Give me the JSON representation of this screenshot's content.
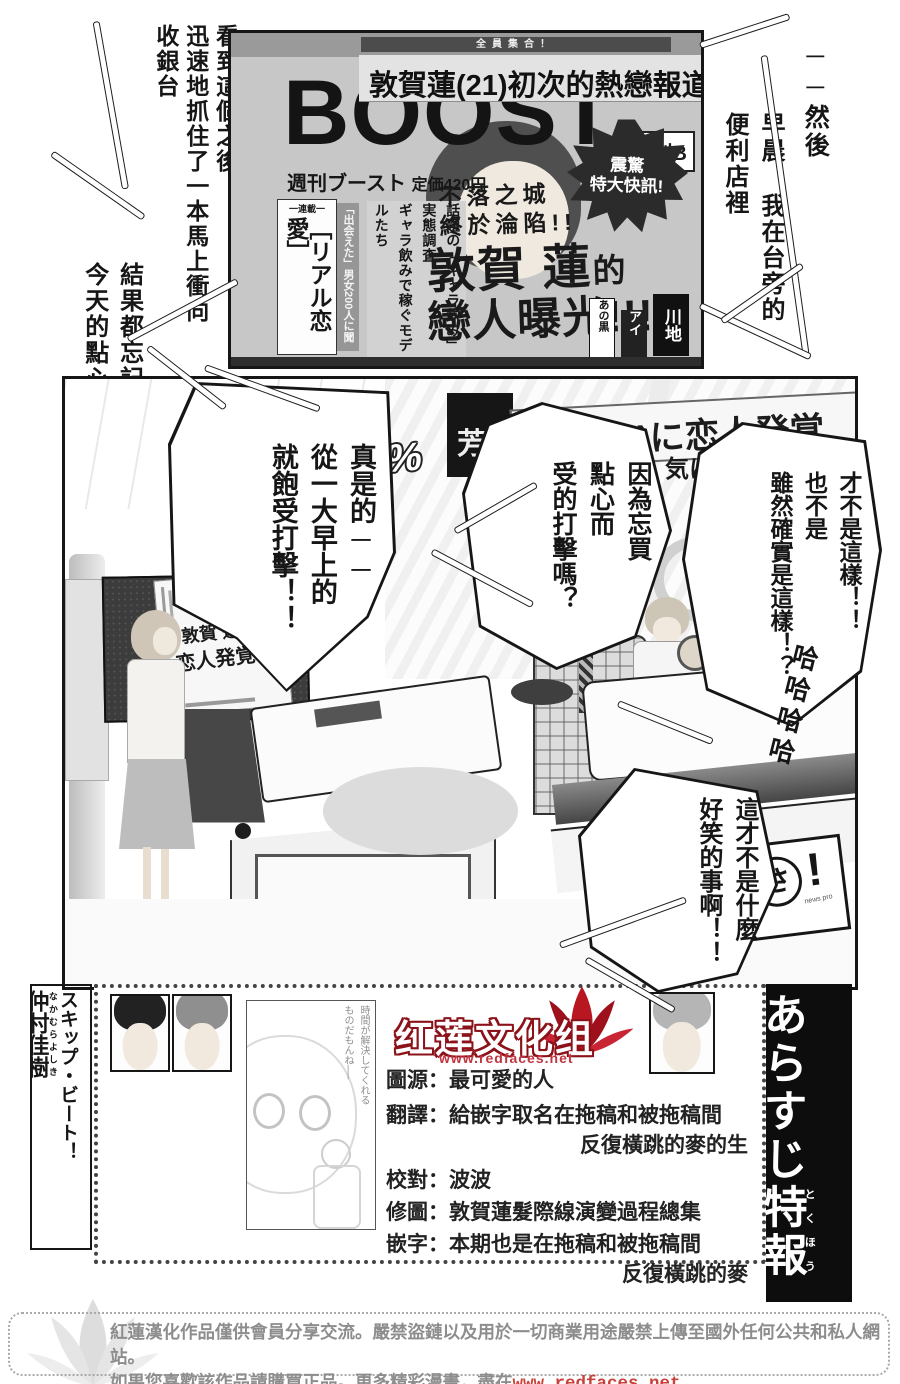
{
  "colors": {
    "ink": "#1a1a1a",
    "lotus_red": "#b81722",
    "link_red": "#c9413a",
    "footer_gray": "#8d8d8d"
  },
  "narration": {
    "then": "──然後",
    "morning": "早晨 我在台旁的\n便利店裡",
    "saw": "看到這個之後\n迅速地抓住了一本馬上衝向\n收銀台",
    "result": "結果都忘記買\n今天的點心了！！"
  },
  "magazine": {
    "top_strip": "全員集合！",
    "headline": "敦賀蓮(21)初次的熱戀報道",
    "logo": "BOOST",
    "issue": "週刊ブースト",
    "price": "定価420円",
    "weekly_b": "週刊B",
    "serial_tag": "一連載一",
    "serial_title": "［リアル恋愛］",
    "feature": "話題の「ギャラ飲み」実態調査\nギャラ飲みで稼ぐモデルたち",
    "feature_side": "「出会えた」男女200人に聞く",
    "burst": "震驚\n特大快訊!",
    "sub_head": "不落之城\n終於淪陷!!",
    "big1": "敦賀 蓮",
    "big1_suffix": "的",
    "big2": "戀人曝光!!!",
    "side1": "川地",
    "side2": "アイ",
    "side3": "あの黒"
  },
  "studio": {
    "weather": "%/0%",
    "ticker_prefix": "芳",
    "ticker": "賀蓮(21)に恋人発覚",
    "ticker2": "気に",
    "sign_boost": "週刊BOOST",
    "poster1": "敦賀 蓮の",
    "poster2": "恋人発覚!!!",
    "asa_a": "あ",
    "asa_sa": "さ",
    "asa_bang": "!",
    "asa_small": "news pro"
  },
  "bubbles": {
    "shock": "真是的──\n從一大早上的\n就飽受打擊！！",
    "ask": "因為忘買\n點心而\n受的打擊嗎？",
    "deny": "才不是這樣！！\n也不是\n雖然確實是這樣！？",
    "laugh": "哈哈哈哈",
    "notfunny": "這才不是什麼\n好笑的事啊！！"
  },
  "credits": {
    "series_title": "スキップ・ビート！",
    "author": "仲村佳樹",
    "author_furigana": "なかむらよしき",
    "group_name": "红莲文化组",
    "group_url": "www.redfaces.net",
    "inset_quote": "時間が解決してくれる\nものだもんね──",
    "lines": [
      "圖源：最可愛的人",
      "翻譯：給嵌字取名在拖稿和被拖稿間",
      "反復橫跳的麥的生",
      "校對：波波",
      "修圖：敦賀蓮髮際線演變過程總集",
      "嵌字：本期也是在拖稿和被拖稿間",
      "反復橫跳的麥"
    ],
    "right_bar_1": "あらすじ",
    "right_bar_2": "特報",
    "right_bar_2_furigana": "とくほう"
  },
  "footer": {
    "line1": "紅蓮漢化作品僅供會員分享交流。嚴禁盜鏈以及用於一切商業用途嚴禁上傳至國外任何公共和私人網站。",
    "line2_prefix": "如果您喜歡該作品請購買正品。更多精彩漫畫，盡在",
    "link": "www.redfaces.net"
  }
}
